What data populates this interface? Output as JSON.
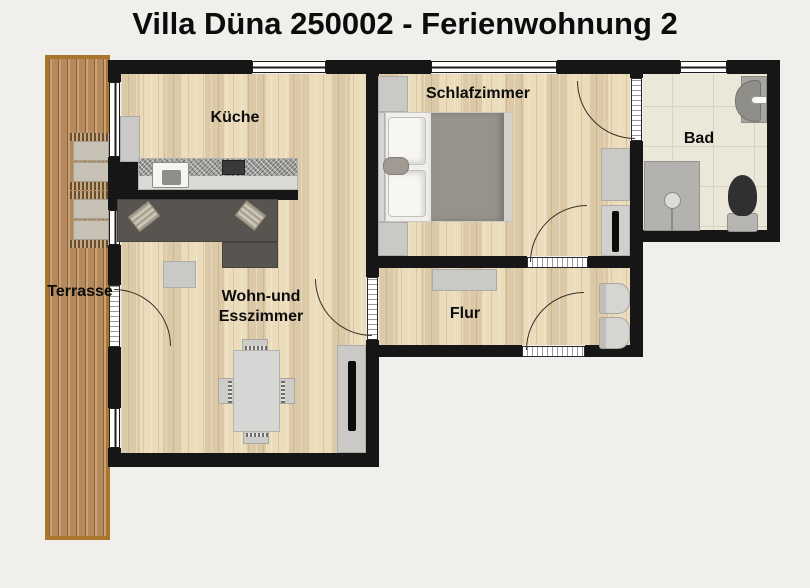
{
  "title": "Villa Düna 250002 - Ferienwohnung 2",
  "rooms": {
    "kitchen": {
      "label": "Küche"
    },
    "bedroom": {
      "label": "Schlafzimmer"
    },
    "bathroom": {
      "label": "Bad"
    },
    "hallway": {
      "label": "Flur"
    },
    "living": {
      "label_line1": "Wohn-und",
      "label_line2": "Esszimmer"
    },
    "terrace": {
      "label": "Terrasse"
    }
  },
  "colors": {
    "bg": "#f0efeb",
    "wall": "#161616",
    "wood": "#e6d6b6",
    "deck": "#b68a5c",
    "deck-border": "#a9762e",
    "tile": "#ebe7d9",
    "grout": "#d8d4c4",
    "sofa": "#585450",
    "gray-furn": "#cbc9c5",
    "text": "#0c0c0c"
  }
}
